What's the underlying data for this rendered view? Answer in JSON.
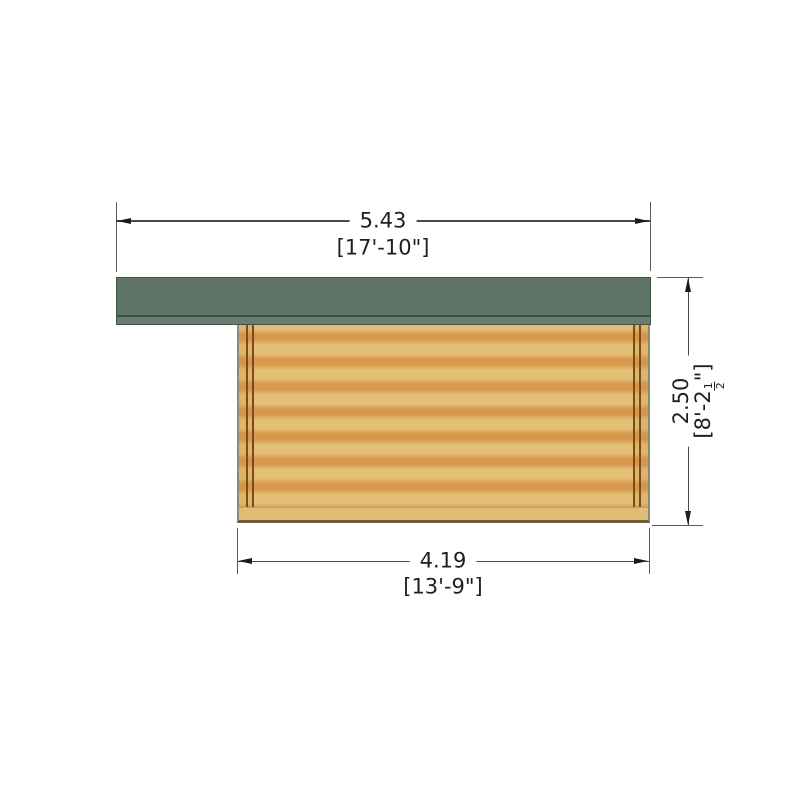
{
  "dimensions": {
    "overall_width": {
      "metric": "5.43",
      "imperial": "[17'-10\"]"
    },
    "wall_width": {
      "metric": "4.19",
      "imperial": "[13'-9\"]"
    },
    "wall_height": {
      "metric": "2.50",
      "imperial_prefix": "[8'-2",
      "imperial_frac_num": "1",
      "imperial_frac_den": "2",
      "imperial_suffix": "\"]"
    }
  },
  "colors": {
    "roof_green": "#5d7467",
    "roof_fascia_green": "#667d6f",
    "roof_edge": "#44544a",
    "wood_light": "#e3c076",
    "wood_dark": "#d8994f",
    "post_line_brown": "#7a4b1c",
    "dimension_line": "#4a4a4a",
    "text": "#1f1f1f",
    "background": "#ffffff"
  }
}
